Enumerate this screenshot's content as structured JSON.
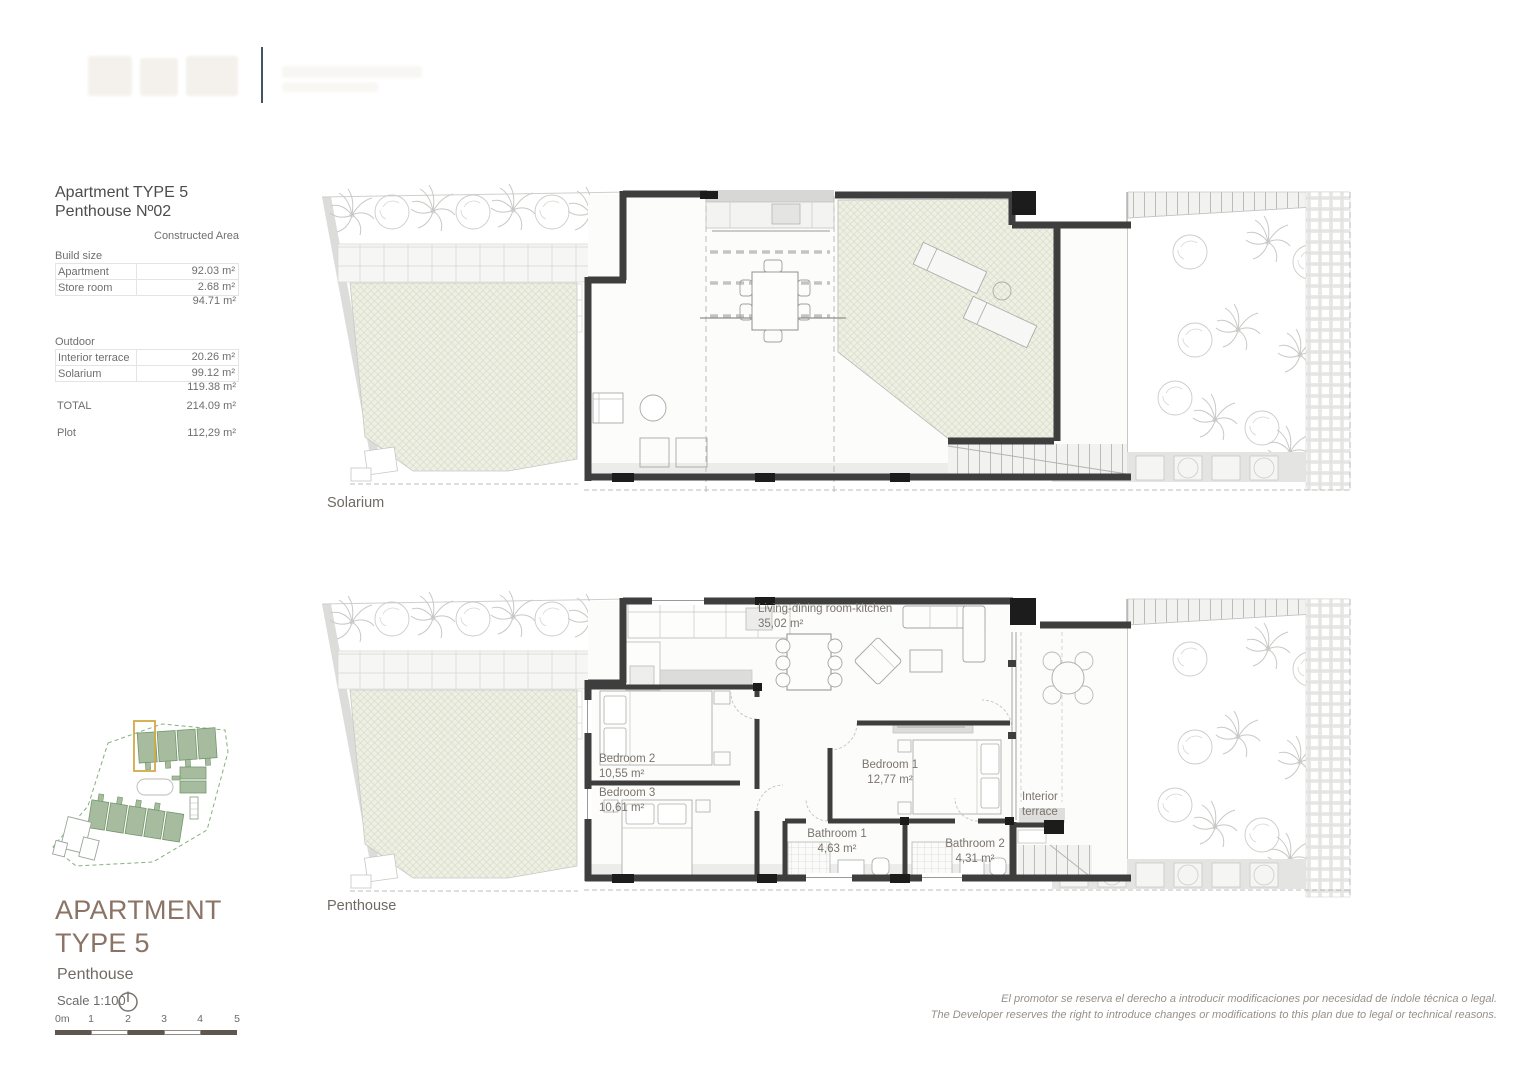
{
  "info_panel": {
    "title_line1": "Apartment TYPE 5",
    "title_line2": "Penthouse Nº02",
    "column_header": "Constructed Area",
    "build_size_label": "Build size",
    "rows_build": [
      {
        "label": "Apartment",
        "value": "92.03 m²"
      },
      {
        "label": "Store room",
        "value": "2.68 m²"
      }
    ],
    "build_subtotal": "94.71 m²",
    "outdoor_label": "Outdoor",
    "rows_outdoor": [
      {
        "label": "Interior terrace",
        "value": "20.26 m²"
      },
      {
        "label": "Solarium",
        "value": "99.12 m²"
      }
    ],
    "outdoor_subtotal": "119.38 m²",
    "total_label": "TOTAL",
    "total_value": "214.09 m²",
    "plot_label": "Plot",
    "plot_value": "112,29 m²"
  },
  "plans": {
    "solarium": {
      "caption": "Solarium"
    },
    "penthouse": {
      "caption": "Penthouse",
      "rooms": [
        {
          "name": "Living-dining room-kitchen",
          "area": "35,02 m²"
        },
        {
          "name": "Bedroom 2",
          "area": "10,55 m²"
        },
        {
          "name": "Bedroom 3",
          "area": "10,61 m²"
        },
        {
          "name": "Bedroom 1",
          "area": "12,77 m²"
        },
        {
          "name": "Bathroom 1",
          "area": "4,63 m²"
        },
        {
          "name": "Bathroom 2",
          "area": "4,31 m²"
        },
        {
          "name": "Interior terrace",
          "area": ""
        }
      ]
    }
  },
  "title_block": {
    "line1": "APARTMENT",
    "line2": "TYPE 5",
    "floor": "Penthouse",
    "scale_label": "Scale 1:100",
    "scale_ticks": [
      "0m",
      "1",
      "2",
      "3",
      "4",
      "5"
    ]
  },
  "disclaimer": {
    "line_es": "El promotor se reserva el derecho a introducir modificaciones por necesidad de índole técnica o legal.",
    "line_en": "The Developer reserves the right to introduce changes or modifications to this plan due to legal or technical reasons."
  },
  "colors": {
    "wall": "#3e3e3e",
    "accent_brown": "#8b7365",
    "hatch_fill": "#eff0e5",
    "site_green": "#a7bc9f",
    "highlight_gold": "#d1a945"
  }
}
